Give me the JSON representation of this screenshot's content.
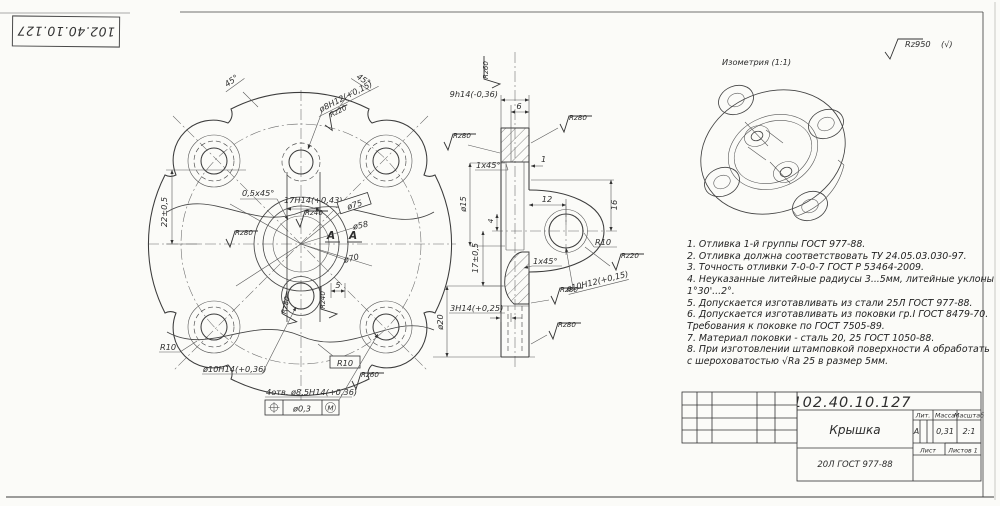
{
  "stamp": {
    "number": "102.40.10.127"
  },
  "iso": {
    "title": "Изометрия (1:1)"
  },
  "corner_roughness": {
    "value": "Rz950",
    "paren": "(√)"
  },
  "notes": [
    "1. Отливка 1-й группы ГОСТ 977-88.",
    "2. Отливка должна соответствовать ТУ 24.05.03.030-97.",
    "3. Точность отливки 7-0-0-7 ГОСТ Р 53464-2009.",
    "4. Неуказанные литейные радиусы 3...5мм, литейные уклоны",
    "1°30'...2°.",
    "5. Допускается изготавливать из стали 25Л ГОСТ 977-88.",
    "6. Допускается изготавливать из поковки гр.I ГОСТ 8479-70.",
    "Требования к поковке по ГОСТ 7505-89.",
    "7. Материал поковки - сталь 20, 25 ГОСТ 1050-88.",
    "8. При изготовлении штамповкой поверхности А обработать",
    "с шероховатостью √Ra 25 в размер 5мм."
  ],
  "front": {
    "angle_l": "45°",
    "angle_r": "45°",
    "hole_top": "ø8H12(+0,15)",
    "rz20": "Rz20",
    "dim22": "22±0,5",
    "chamfer": "0,5x45°",
    "slot": "17H14(+0,43)",
    "rz40a": "Rz40",
    "rz80a": "Rz80",
    "d75": "ø75",
    "d58": "ø58",
    "d70": "ø70",
    "sec_a": "А",
    "dim5": "5",
    "rz40b": "Rz40",
    "rz80b": "Rz80",
    "hole_bot": "ø10H14(+0,36)",
    "r10l": "R10",
    "r10r": "R10",
    "rz60": "Rz60",
    "holes": "4отв. ø8,5H14(+0,36)",
    "fcf": "ø0,3",
    "fcf_m": "М"
  },
  "section": {
    "rz60_top": "Rz60",
    "dim9": "9h14(-0,36)",
    "dim6": "6",
    "rz80r": "Rz80",
    "rz80l": "Rz80",
    "ch1": "1x45°",
    "d15": "ø15",
    "dim1": "1",
    "dim12": "12",
    "dim16": "16",
    "dim4": "4",
    "dim17": "17±0,5",
    "ch2": "1x45°",
    "r10": "R10",
    "rz20": "Rz20",
    "hole": "ø10H12(+0,15)",
    "rz80m": "Rz80",
    "dim3": "3H14(+0,25)",
    "d20": "ø20",
    "rz80b": "Rz80"
  },
  "tb": {
    "number": "102.40.10.127",
    "name": "Крышка",
    "lit_h": "Лит.",
    "mass_h": "Масса",
    "scale_h": "Масштаб",
    "lit": "А",
    "mass": "0,31",
    "scale": "2:1",
    "sheet": "Лист",
    "sheets": "Листов 1",
    "material": "20Л ГОСТ 977-88"
  }
}
